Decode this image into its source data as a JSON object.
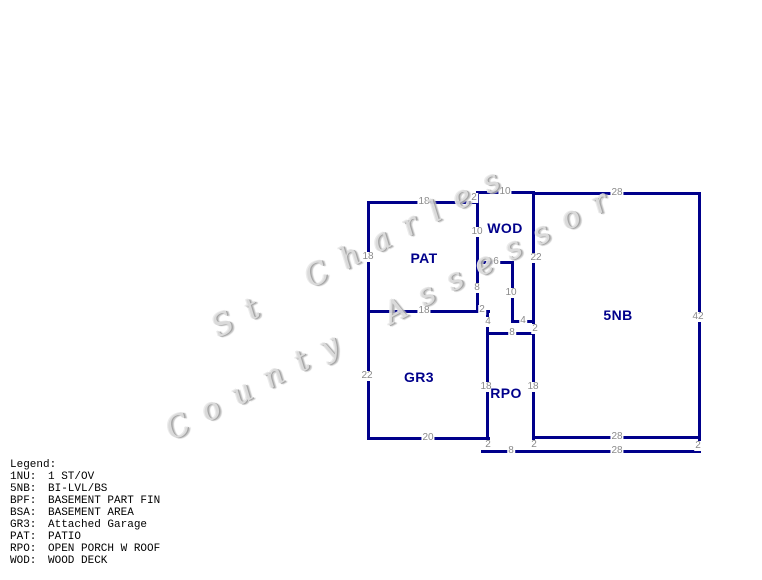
{
  "watermark": {
    "line1": "St Charles",
    "line2": "County Assessor",
    "color": "#c9c9c9"
  },
  "sketch": {
    "line_color": "#00008B",
    "area_label_color": "#00008B",
    "dimension_color": "#8a8a8a",
    "walls": [
      [
        477,
        192,
        533,
        192
      ],
      [
        368,
        202,
        477,
        202
      ],
      [
        477,
        262,
        512,
        262
      ],
      [
        368,
        311,
        488,
        311
      ],
      [
        512,
        321,
        533,
        321
      ],
      [
        487,
        333,
        533,
        333
      ],
      [
        533,
        193,
        699,
        193
      ],
      [
        368,
        438,
        488,
        438
      ],
      [
        533,
        437,
        699,
        437
      ],
      [
        482,
        451,
        699,
        451
      ],
      [
        368,
        202,
        368,
        438
      ],
      [
        477,
        192,
        477,
        311
      ],
      [
        512,
        262,
        512,
        321
      ],
      [
        533,
        192,
        533,
        437
      ],
      [
        487,
        311,
        487,
        438
      ],
      [
        699,
        193,
        699,
        437
      ],
      [
        487,
        438,
        487,
        451
      ],
      [
        533,
        437,
        533,
        451
      ],
      [
        699,
        437,
        699,
        451
      ]
    ],
    "area_labels": [
      {
        "label": "PAT",
        "x": 424,
        "y": 258
      },
      {
        "label": "WOD",
        "x": 505,
        "y": 228
      },
      {
        "label": "GR3",
        "x": 419,
        "y": 377
      },
      {
        "label": "RPO",
        "x": 506,
        "y": 393
      },
      {
        "label": "5NB",
        "x": 618,
        "y": 315
      }
    ],
    "dimensions": [
      {
        "value": "10",
        "x": 505,
        "y": 192
      },
      {
        "value": "2",
        "x": 474,
        "y": 198
      },
      {
        "value": "18",
        "x": 424,
        "y": 202
      },
      {
        "value": "18",
        "x": 368,
        "y": 257
      },
      {
        "value": "10",
        "x": 477,
        "y": 232
      },
      {
        "value": "6",
        "x": 496,
        "y": 262
      },
      {
        "value": "8",
        "x": 477,
        "y": 288
      },
      {
        "value": "22",
        "x": 536,
        "y": 258
      },
      {
        "value": "10",
        "x": 511,
        "y": 293
      },
      {
        "value": "4",
        "x": 523,
        "y": 321
      },
      {
        "value": "2",
        "x": 535,
        "y": 329
      },
      {
        "value": "28",
        "x": 617,
        "y": 193
      },
      {
        "value": "42",
        "x": 698,
        "y": 317
      },
      {
        "value": "18",
        "x": 424,
        "y": 311
      },
      {
        "value": "2",
        "x": 482,
        "y": 310
      },
      {
        "value": "4",
        "x": 488,
        "y": 322
      },
      {
        "value": "8",
        "x": 512,
        "y": 333
      },
      {
        "value": "22",
        "x": 367,
        "y": 376
      },
      {
        "value": "18",
        "x": 486,
        "y": 387
      },
      {
        "value": "18",
        "x": 533,
        "y": 387
      },
      {
        "value": "20",
        "x": 428,
        "y": 438
      },
      {
        "value": "28",
        "x": 617,
        "y": 437
      },
      {
        "value": "2",
        "x": 488,
        "y": 445
      },
      {
        "value": "2",
        "x": 534,
        "y": 445
      },
      {
        "value": "8",
        "x": 511,
        "y": 451
      },
      {
        "value": "28",
        "x": 617,
        "y": 451
      },
      {
        "value": "2",
        "x": 698,
        "y": 446
      }
    ]
  },
  "legend": {
    "title": "Legend:",
    "entries": [
      {
        "code": "1NU:",
        "desc": "1 ST/OV"
      },
      {
        "code": "5NB:",
        "desc": "BI-LVL/BS"
      },
      {
        "code": "BPF:",
        "desc": "BASEMENT PART FIN"
      },
      {
        "code": "BSA:",
        "desc": "BASEMENT AREA"
      },
      {
        "code": "GR3:",
        "desc": "Attached Garage"
      },
      {
        "code": "PAT:",
        "desc": "PATIO"
      },
      {
        "code": "RPO:",
        "desc": "OPEN PORCH W ROOF"
      },
      {
        "code": "WOD:",
        "desc": "WOOD DECK"
      }
    ]
  }
}
